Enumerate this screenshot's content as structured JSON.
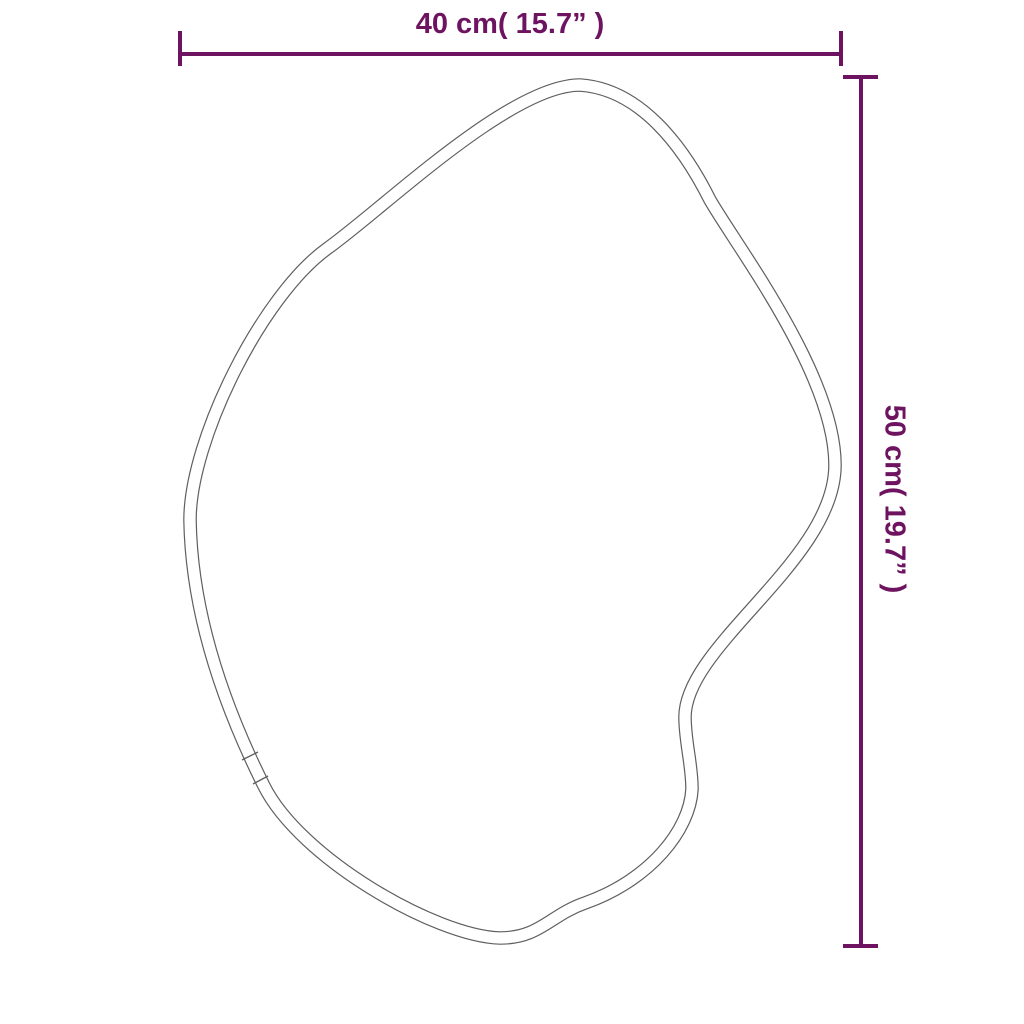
{
  "diagram": {
    "type": "product-dimension-diagram",
    "subject": "organic-blob-mirror-outline",
    "width_dimension": {
      "label": "40 cm( 15.7” )"
    },
    "height_dimension": {
      "label": "50 cm( 19.7” )"
    }
  },
  "colors": {
    "accent": "#6e1360",
    "outline": "#5f5f5f",
    "background": "#ffffff"
  }
}
